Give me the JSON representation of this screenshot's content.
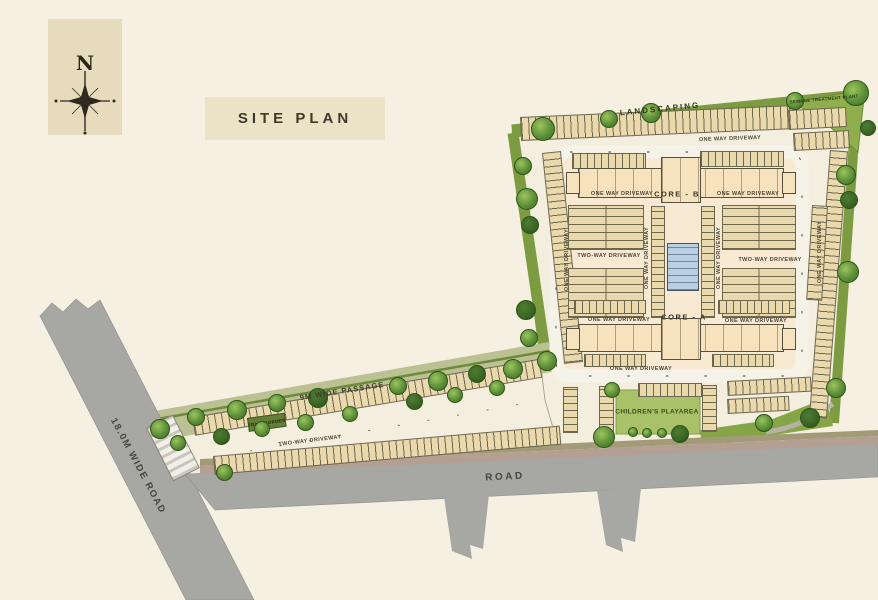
{
  "title": "SITE PLAN",
  "compass": {
    "north_label": "N"
  },
  "labels": {
    "landscaping": "LANDSCAPING",
    "sewage_treatment_plant": "SEWAGE TREATMENT PLANT",
    "one_way_driveway": "ONE WAY DRIVEWAY",
    "two_way_driveway": "TWO-WAY DRIVEWAY",
    "core_a": "CORE - A",
    "core_b": "CORE - B",
    "childrens_playarea": "CHILDREN'S PLAYAREA",
    "transformer": "TRANSFORMER",
    "passage_9m": "9M WIDE PASSAGE",
    "road_18m": "18.0M WIDE ROAD",
    "road": "ROAD"
  },
  "colors": {
    "background": "#f5f0e2",
    "panel": "#e6dcbd",
    "green_belt": "#7d9c42",
    "lawn": "#a9c168",
    "road_gray": "#a7a7a3",
    "basement": "#f8e9d3",
    "building": "#f6e2bd",
    "water_tank_blue": "#b9cfe2"
  }
}
